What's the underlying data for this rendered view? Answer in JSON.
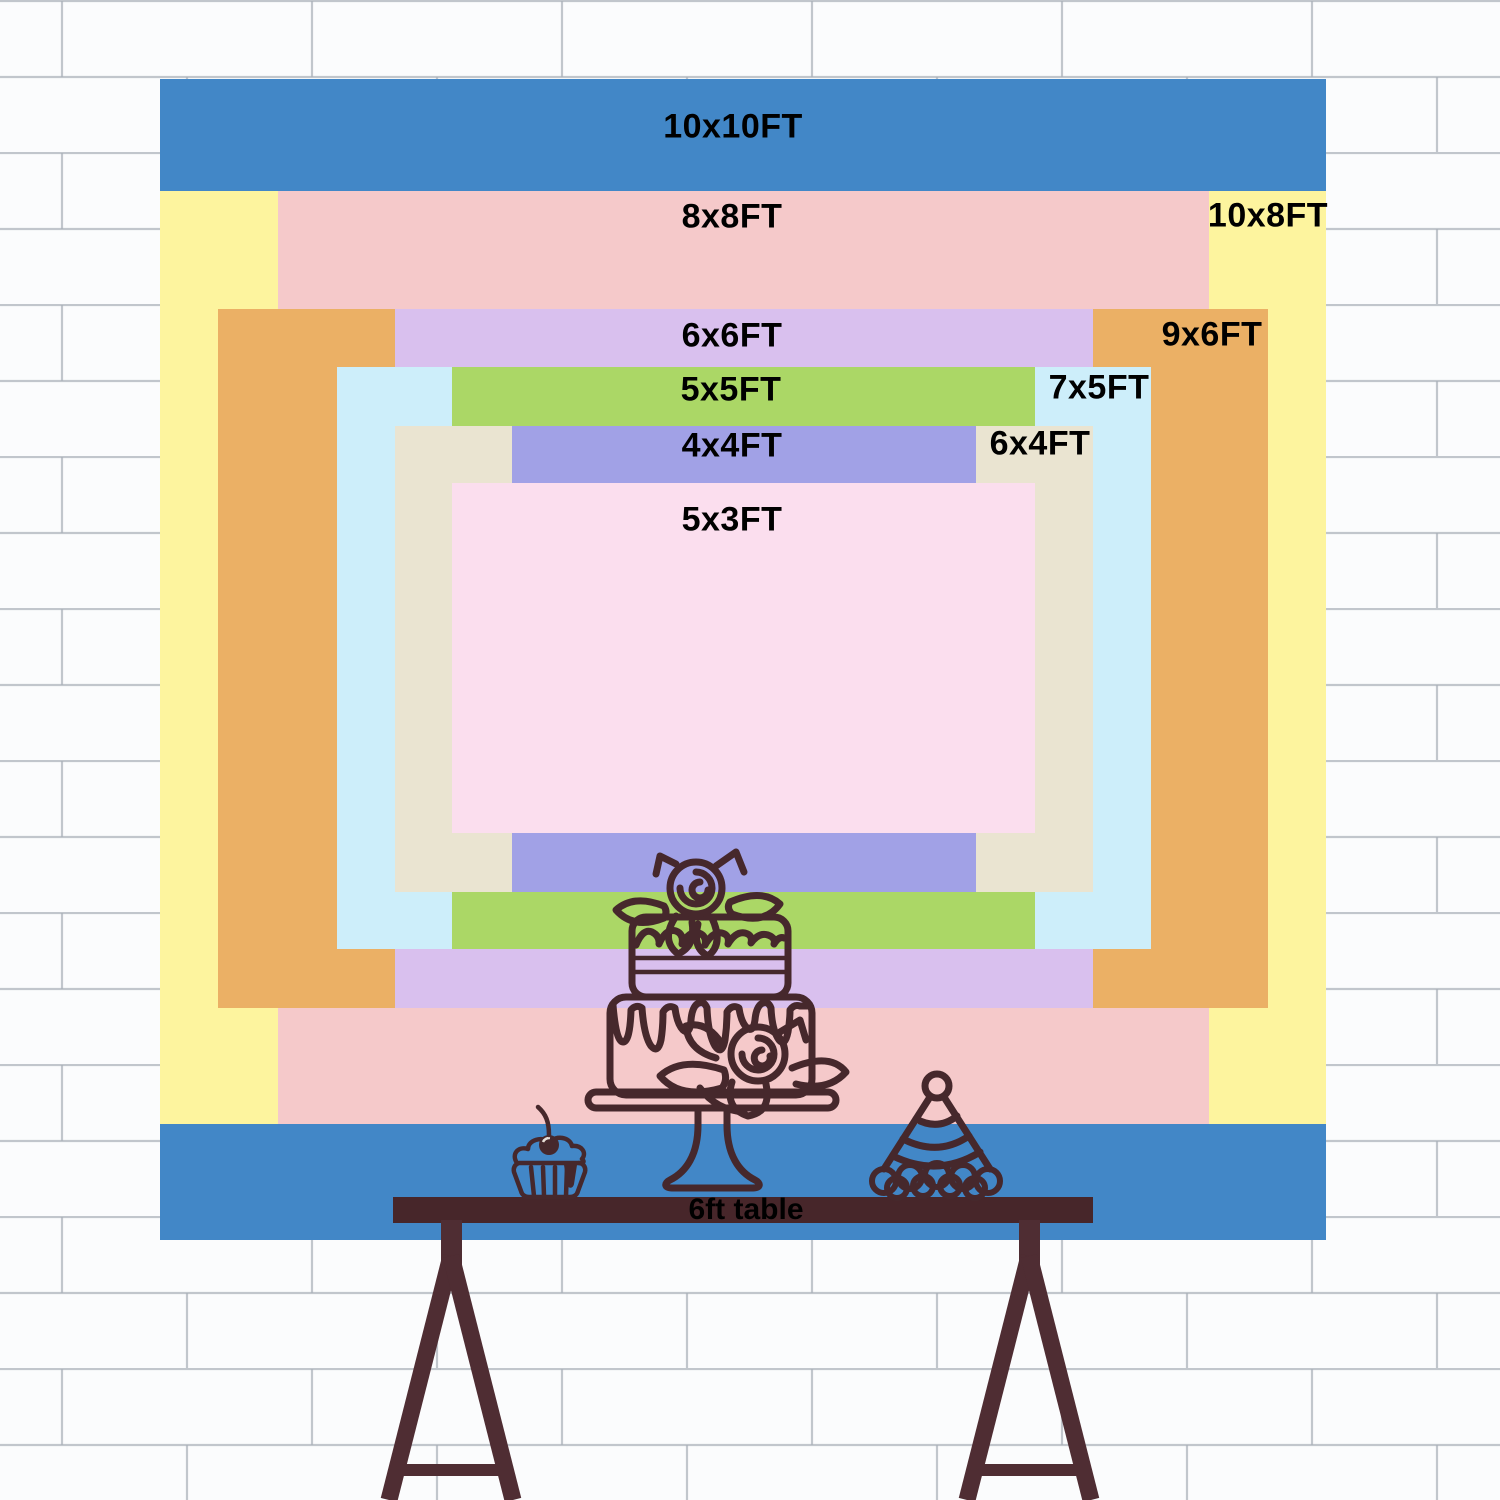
{
  "scene": {
    "width_px": 1500,
    "height_px": 1500,
    "wall_background": "#fbfcfd",
    "brick_line_color": "#a9afb8"
  },
  "backdrop": {
    "px_per_ft": 116.4,
    "label_text_color": "#000000",
    "layers": [
      {
        "name": "10x10ft",
        "label": "10x10FT",
        "width_ft": 10,
        "height_ft": 10,
        "color": "#4287c7",
        "x": 160,
        "y": 79,
        "w": 1166,
        "h": 1161,
        "label_x": 733,
        "label_y": 127
      },
      {
        "name": "10x8ft",
        "label": "10x8FT",
        "width_ft": 10,
        "height_ft": 8,
        "color": "#fdf49e",
        "x": 160,
        "y": 191,
        "w": 1166,
        "h": 933,
        "label_x": 1268,
        "label_y": 216
      },
      {
        "name": "8x8ft",
        "label": "8x8FT",
        "width_ft": 8,
        "height_ft": 8,
        "color": "#f5c9ca",
        "x": 278,
        "y": 191,
        "w": 931,
        "h": 933,
        "label_x": 732,
        "label_y": 217
      },
      {
        "name": "9x6ft",
        "label": "9x6FT",
        "width_ft": 9,
        "height_ft": 6,
        "color": "#ebb065",
        "x": 218,
        "y": 309,
        "w": 1050,
        "h": 699,
        "label_x": 1212,
        "label_y": 335
      },
      {
        "name": "6x6ft",
        "label": "6x6FT",
        "width_ft": 6,
        "height_ft": 6,
        "color": "#d9c0ee",
        "x": 395,
        "y": 309,
        "w": 698,
        "h": 699,
        "label_x": 732,
        "label_y": 336
      },
      {
        "name": "7x5ft",
        "label": "7x5FT",
        "width_ft": 7,
        "height_ft": 5,
        "color": "#cdeefa",
        "x": 337,
        "y": 367,
        "w": 814,
        "h": 582,
        "label_x": 1099,
        "label_y": 388
      },
      {
        "name": "5x5ft",
        "label": "5x5FT",
        "width_ft": 5,
        "height_ft": 5,
        "color": "#abd766",
        "x": 452,
        "y": 367,
        "w": 583,
        "h": 582,
        "label_x": 731,
        "label_y": 390
      },
      {
        "name": "6x4ft",
        "label": "6x4FT",
        "width_ft": 6,
        "height_ft": 4,
        "color": "#eae4d1",
        "x": 395,
        "y": 426,
        "w": 698,
        "h": 466,
        "label_x": 1040,
        "label_y": 444
      },
      {
        "name": "4x4ft",
        "label": "4x4FT",
        "width_ft": 4,
        "height_ft": 4,
        "color": "#a1a1e6",
        "x": 512,
        "y": 426,
        "w": 464,
        "h": 466,
        "label_x": 732,
        "label_y": 446
      },
      {
        "name": "5x3ft",
        "label": "5x3FT",
        "width_ft": 5,
        "height_ft": 3,
        "color": "#fbdeee",
        "x": 452,
        "y": 483,
        "w": 583,
        "h": 350,
        "label_x": 732,
        "label_y": 520
      }
    ]
  },
  "table": {
    "label": "6ft table",
    "bar_color": "#47262a",
    "leg_color": "#4f2d33",
    "label_x": 746,
    "label_y": 1210
  },
  "drawing": {
    "outline_color": "#46282c",
    "items": [
      "two-tier-cake-on-stand",
      "cupcake-with-cherry",
      "party-hat"
    ]
  }
}
